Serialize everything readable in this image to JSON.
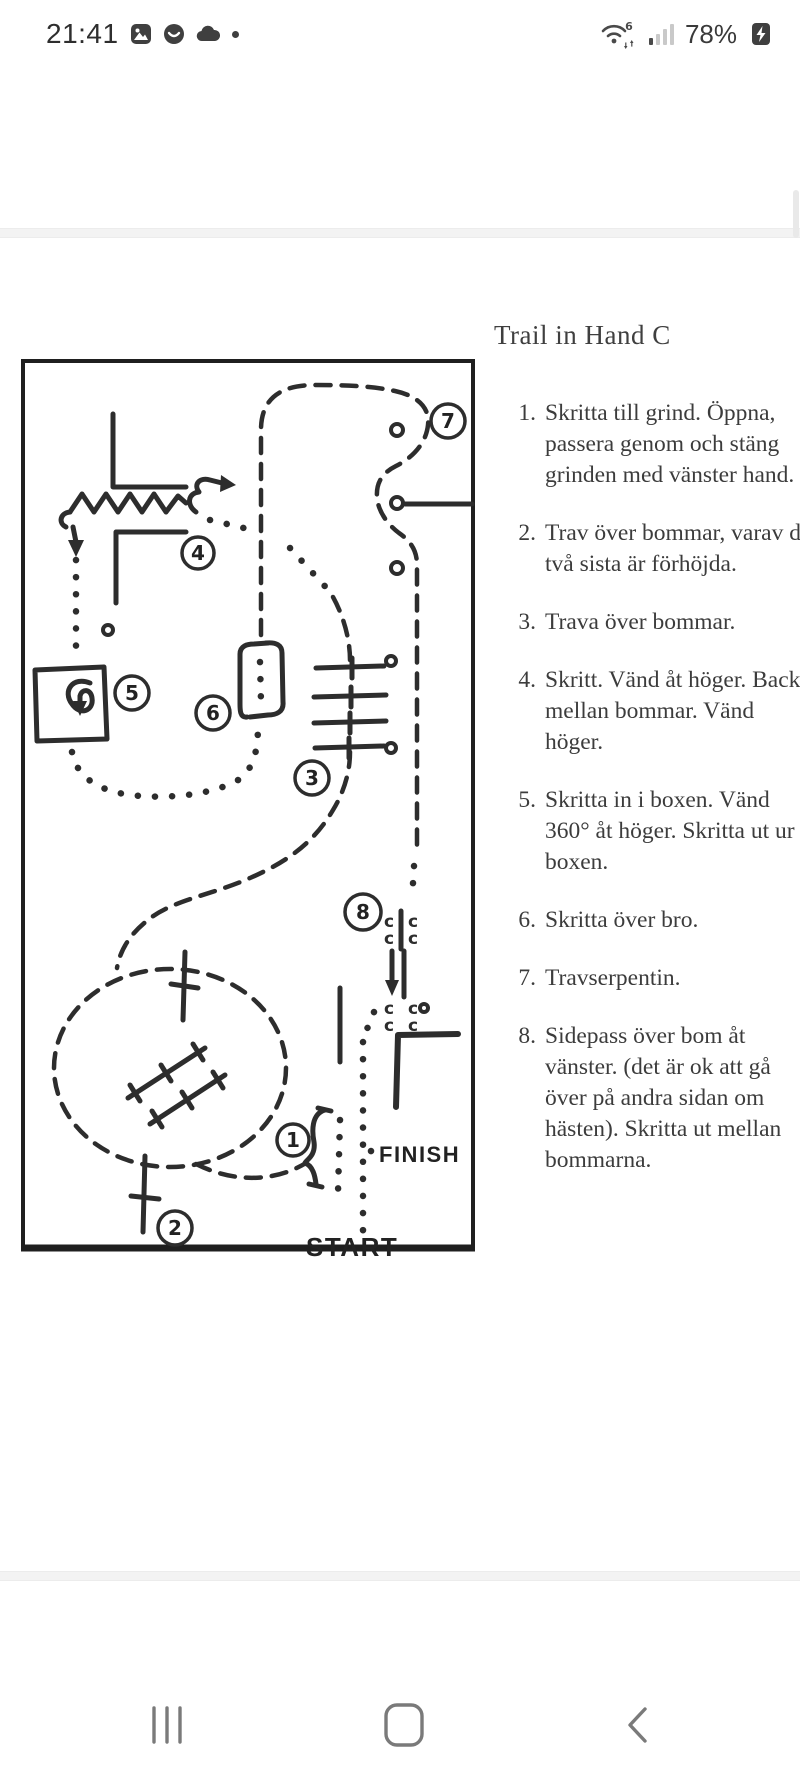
{
  "status_bar": {
    "time": "21:41",
    "wifi_label": "6",
    "battery_percent": "78%",
    "left_icons": [
      "gallery-icon",
      "contacts-app-icon",
      "cloud-icon",
      "notification-dot"
    ],
    "right_icons": [
      "wifi6-icon",
      "signal-strength-icon",
      "battery-charging-icon"
    ]
  },
  "page": {
    "title": "Trail in Hand C",
    "instructions": [
      {
        "num": "1.",
        "text": "Skritta till grind. Öppna, passera genom och stäng grinden med vänster hand."
      },
      {
        "num": "2.",
        "text": "Trav över bommar, varav de två sista är förhöjda."
      },
      {
        "num": "3.",
        "text": "Trava över bommar."
      },
      {
        "num": "4.",
        "text": "Skritt. Vänd åt höger. Backa mellan bommar. Vänd höger."
      },
      {
        "num": "5.",
        "text": "Skritta in i boxen. Vänd 360° åt höger. Skritta ut ur boxen."
      },
      {
        "num": "6.",
        "text": "Skritta över bro."
      },
      {
        "num": "7.",
        "text": "Travserpentin."
      },
      {
        "num": "8.",
        "text": "Sidepass över bom åt vänster. (det är ok att gå över på andra sidan om hästen). Skritta ut mellan bommarna."
      }
    ],
    "diagram": {
      "start_label": "START",
      "finish_label": "FINISH",
      "pole_mark": "c",
      "markers": [
        "1",
        "2",
        "3",
        "4",
        "5",
        "6",
        "7",
        "8"
      ]
    }
  },
  "nav_bar": {
    "buttons": [
      "recents",
      "home",
      "back"
    ]
  }
}
